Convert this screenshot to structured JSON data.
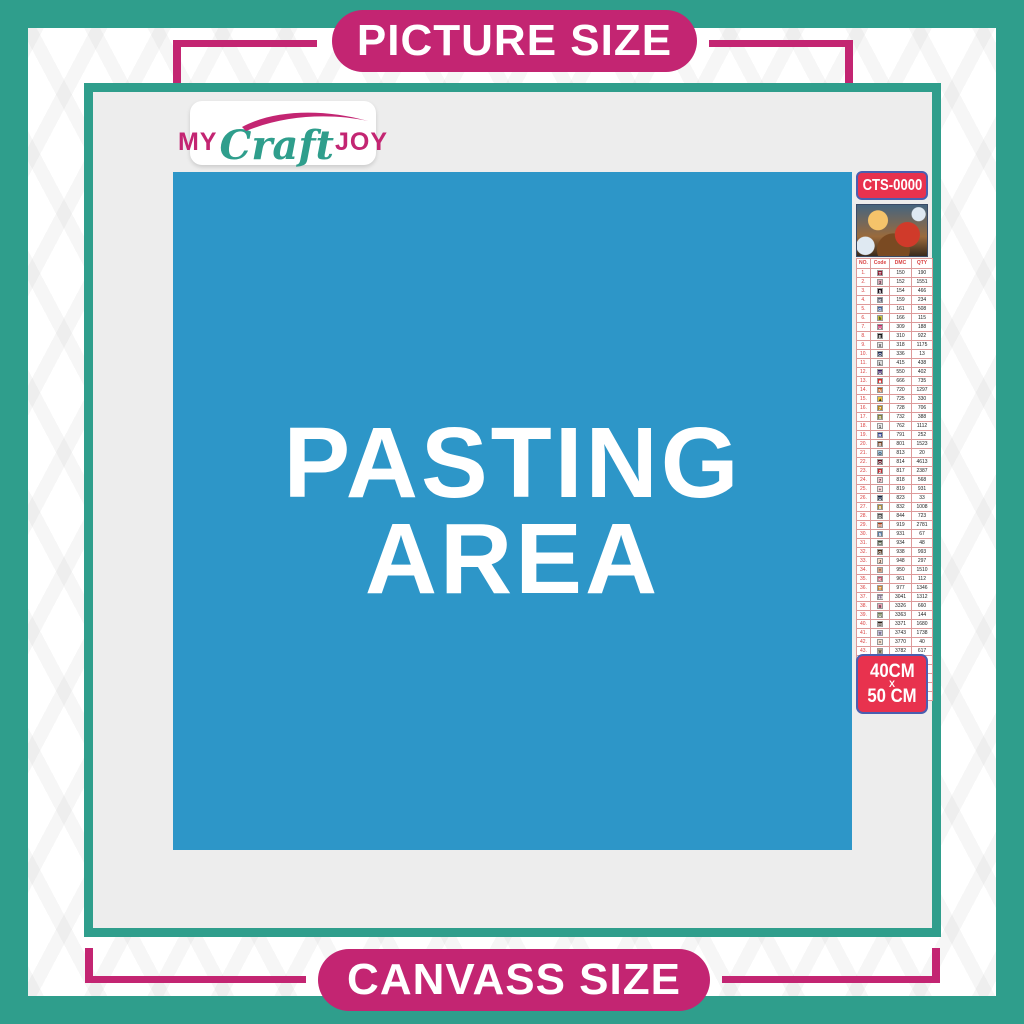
{
  "banners": {
    "top": "PICTURE SIZE",
    "bottom": "CANVASS SIZE"
  },
  "logo": {
    "my": "MY",
    "craft": "Craft",
    "joy": "JOY"
  },
  "pasting_area": {
    "line1": "PASTING",
    "line2": "AREA"
  },
  "sidebar": {
    "sku": "CTS-0000",
    "thumbnail_alt": "christmas-santa-sleigh-scene",
    "size_label": {
      "line1": "40CM",
      "x": "X",
      "line2": "50 CM"
    },
    "table": {
      "headers": [
        "NO.",
        "Code",
        "DMC",
        "QTY"
      ],
      "row_format": [
        "no",
        "symbol",
        "symbol_bg",
        "symbol_fg",
        "dmc",
        "qty"
      ],
      "rows": [
        [
          "1.",
          "T",
          "#8c1c33",
          "#ffffff",
          "150",
          "190"
        ],
        [
          "2.",
          "3",
          "#d9aebb",
          "#5a3340",
          "152",
          "1551"
        ],
        [
          "3.",
          "5",
          "#1c0f1e",
          "#ffffff",
          "154",
          "466"
        ],
        [
          "4.",
          "K",
          "#5a5e74",
          "#ffffff",
          "159",
          "234"
        ],
        [
          "5.",
          "G",
          "#41609f",
          "#ffffff",
          "161",
          "508"
        ],
        [
          "6.",
          "h",
          "#c9c23f",
          "#333311",
          "166",
          "115"
        ],
        [
          "7.",
          "U",
          "#c12964",
          "#ffffff",
          "309",
          "188"
        ],
        [
          "8.",
          "E",
          "#141414",
          "#ffffff",
          "310",
          "922"
        ],
        [
          "9.",
          "X",
          "#e8e8e8",
          "#333333",
          "318",
          "1175"
        ],
        [
          "10.",
          "O",
          "#1c2a56",
          "#ffffff",
          "336",
          "13"
        ],
        [
          "11.",
          "L",
          "#dcdcdc",
          "#333333",
          "415",
          "438"
        ],
        [
          "12.",
          "U",
          "#3a1f63",
          "#ffffff",
          "550",
          "402"
        ],
        [
          "13.",
          "■",
          "#d42a2a",
          "#ffffff",
          "666",
          "735"
        ],
        [
          "14.",
          "N",
          "#c05415",
          "#ffffff",
          "720",
          "1297"
        ],
        [
          "15.",
          "▲",
          "#edc33b",
          "#333311",
          "725",
          "330"
        ],
        [
          "16.",
          "7",
          "#b98a1f",
          "#ffffff",
          "728",
          "706"
        ],
        [
          "17.",
          "S",
          "#7e7c33",
          "#ffffff",
          "732",
          "388"
        ],
        [
          "18.",
          "1",
          "#ececec",
          "#333333",
          "762",
          "1112"
        ],
        [
          "19.",
          "R",
          "#2c3f8f",
          "#ffffff",
          "791",
          "252"
        ],
        [
          "20.",
          "B",
          "#6b3a1a",
          "#ffffff",
          "801",
          "1523"
        ],
        [
          "21.",
          "⊙",
          "#a8cbe4",
          "#234",
          "813",
          "20"
        ],
        [
          "22.",
          "O",
          "#5e1220",
          "#ffffff",
          "814",
          "4613"
        ],
        [
          "23.",
          "2",
          "#c22f35",
          "#ffffff",
          "817",
          "2387"
        ],
        [
          "24.",
          "7",
          "#f2cdd4",
          "#5a3340",
          "818",
          "568"
        ],
        [
          "25.",
          "+",
          "#f7dfe2",
          "#5a3340",
          "819",
          "931"
        ],
        [
          "26.",
          "U",
          "#152341",
          "#ffffff",
          "823",
          "33"
        ],
        [
          "27.",
          "8",
          "#ab8c3a",
          "#ffffff",
          "832",
          "1008"
        ],
        [
          "28.",
          "D",
          "#4a4a48",
          "#ffffff",
          "844",
          "723"
        ],
        [
          "29.",
          "M",
          "#a63c14",
          "#ffffff",
          "919",
          "2781"
        ],
        [
          "30.",
          "5",
          "#5b7da1",
          "#ffffff",
          "931",
          "67"
        ],
        [
          "31.",
          "H",
          "#3e4a34",
          "#ffffff",
          "934",
          "48"
        ],
        [
          "32.",
          "G",
          "#4a2f17",
          "#ffffff",
          "938",
          "993"
        ],
        [
          "33.",
          "J",
          "#f5dccb",
          "#5a4433",
          "948",
          "297"
        ],
        [
          "34.",
          "*",
          "#d9a88c",
          "#5a4433",
          "950",
          "1510"
        ],
        [
          "35.",
          "K",
          "#c4536a",
          "#ffffff",
          "961",
          "112"
        ],
        [
          "36.",
          "T",
          "#cd8736",
          "#ffffff",
          "977",
          "1346"
        ],
        [
          "37.",
          "13",
          "#8a7794",
          "#ffffff",
          "3041",
          "1312"
        ],
        [
          "38.",
          "9",
          "#e8a2b4",
          "#5a3340",
          "3326",
          "660"
        ],
        [
          "39.",
          "U",
          "#6d7d52",
          "#ffffff",
          "3363",
          "144"
        ],
        [
          "40.",
          "⊟",
          "#2a1c12",
          "#ffffff",
          "3371",
          "1680"
        ],
        [
          "41.",
          "Y",
          "#c6bedd",
          "#333344",
          "3743",
          "1738"
        ],
        [
          "42.",
          "^",
          "#f2e3d3",
          "#5a4433",
          "3770",
          "40"
        ],
        [
          "43.",
          "V",
          "#b3a68c",
          "#333322",
          "3782",
          "617"
        ],
        [
          "44.",
          "2",
          "#c3cc4a",
          "#333311",
          "3819",
          "119"
        ],
        [
          "45.",
          "✓",
          "#f0ecd2",
          "#555533",
          "3823",
          "107"
        ],
        [
          "46.",
          "C",
          "#df9334",
          "#ffffff",
          "3853",
          "1332"
        ],
        [
          "47.",
          "13",
          "#8c4631",
          "#ffffff",
          "3858",
          "2311"
        ],
        [
          "48.",
          "A",
          "#8a715d",
          "#ffffff",
          "3863",
          "1820"
        ]
      ]
    }
  },
  "colors": {
    "teal": "#2f9e8c",
    "magenta": "#c32572",
    "pasting_blue": "#2d96c8",
    "badge_red": "#e8324e",
    "badge_border_blue": "#4a5fb0",
    "canvas_gray": "#ededed",
    "table_accent_red": "#d94040"
  }
}
